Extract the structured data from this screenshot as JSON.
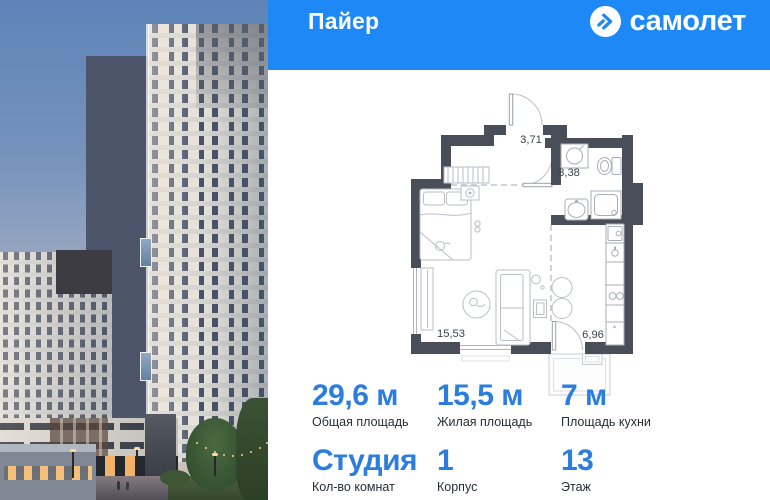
{
  "header": {
    "project_title": "Пайер",
    "brand": {
      "name": "самолет",
      "icon": "samolet-logo-icon"
    },
    "bg_color": "#1e88f7"
  },
  "floor_plan": {
    "room_areas": {
      "hallway": "3,71",
      "bathroom": "3,38",
      "living_room": "15,53",
      "kitchen": "6,96"
    },
    "wall_color": "#4a4e59"
  },
  "stats": {
    "accent_color": "#2b7dde",
    "cells": [
      {
        "value": "29,6 м",
        "label": "Общая площадь"
      },
      {
        "value": "15,5 м",
        "label": "Жилая площадь"
      },
      {
        "value": "7 м",
        "label": "Площадь кухни"
      },
      {
        "value": "Студия",
        "label": "Кол-во комнат"
      },
      {
        "value": "1",
        "label": "Корпус"
      },
      {
        "value": "13",
        "label": "Этаж"
      }
    ]
  }
}
